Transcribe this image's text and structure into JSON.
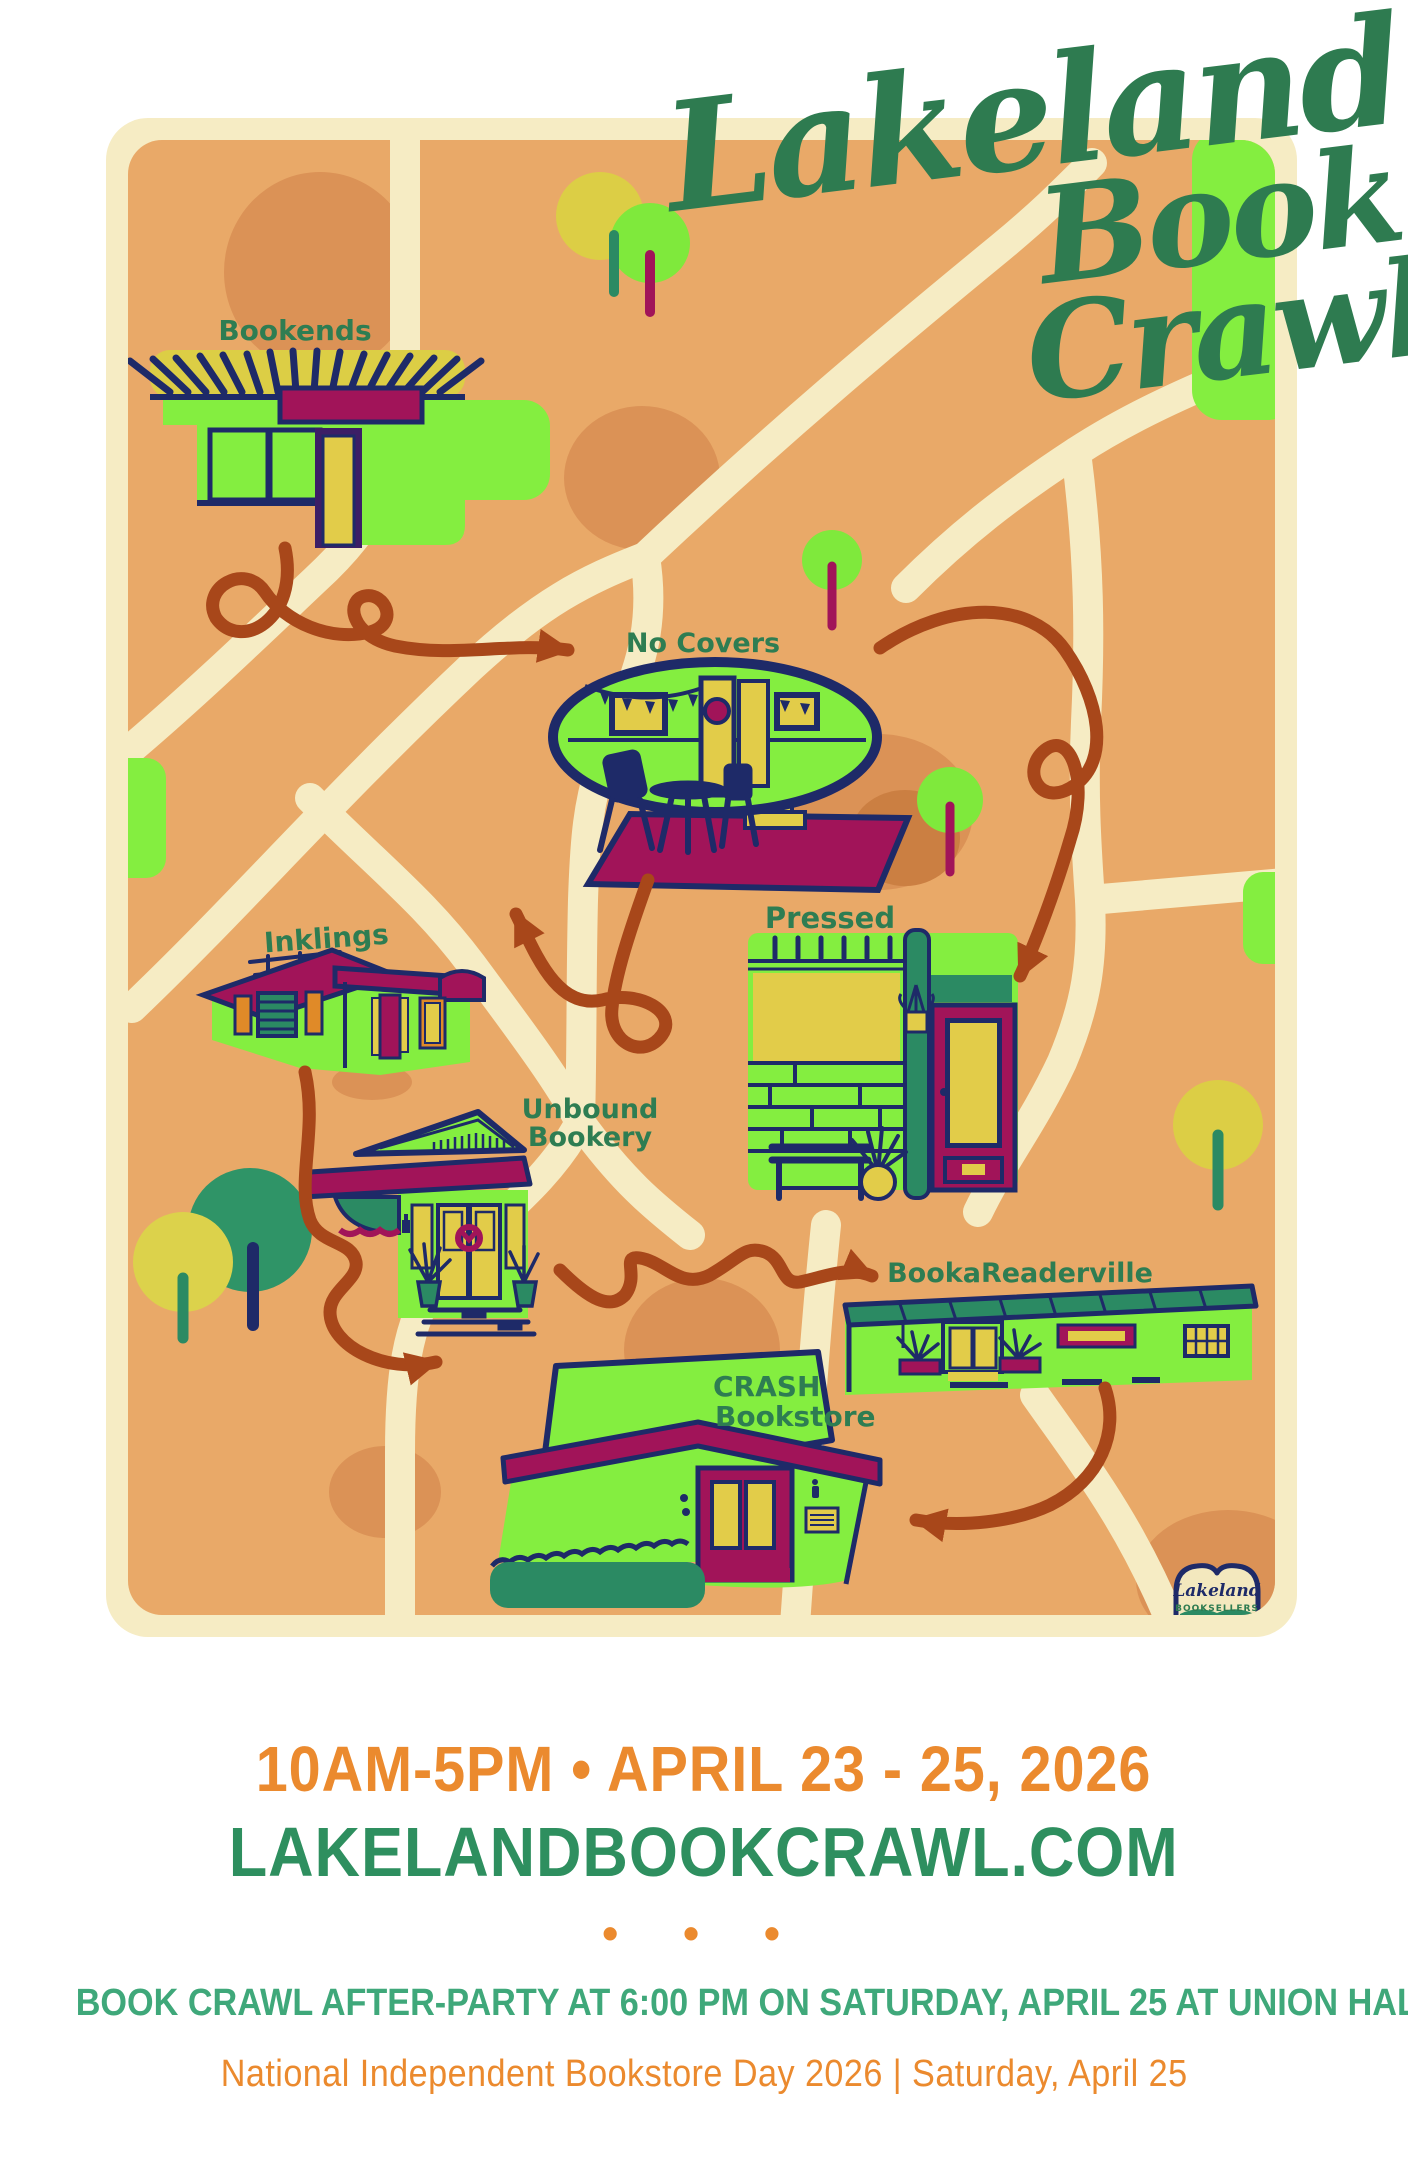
{
  "title": {
    "line1": "Lakeland",
    "line2": "Book",
    "line3": "Crawl"
  },
  "map": {
    "stores": [
      {
        "label": "Bookends"
      },
      {
        "label": "No Covers"
      },
      {
        "label": "Inklings"
      },
      {
        "label": "Pressed"
      },
      {
        "label": "Unbound",
        "label2": "Bookery"
      },
      {
        "label": "BookaReaderville"
      },
      {
        "label": "CRASH",
        "label2": "Bookstore"
      }
    ]
  },
  "logo": {
    "name": "Lakeland",
    "subtitle": "BOOKSELLERS"
  },
  "footer": {
    "hours_dates": "10AM-5PM • APRIL 23 - 25, 2026",
    "website": "LAKELANDBOOKCRAWL.COM",
    "dots": "• • •",
    "afterparty": "BOOK CRAWL AFTER-PARTY AT 6:00 PM ON SATURDAY, APRIL 25 AT UNION HALL",
    "national_day": "National Independent Bookstore Day 2026  | Saturday, April 25"
  },
  "colors": {
    "map_orange": "#E9A968",
    "road_cream": "#F6ECC4",
    "blob_orange": "#DB9256",
    "bright_green": "#84EE40",
    "navy": "#1E2A68",
    "maroon": "#A11459",
    "yellow": "#E2CC49",
    "teal": "#2B8A63",
    "title_green": "#2E7B50",
    "footer_orange": "#EB8A2E",
    "footer_green": "#2E8F5F",
    "arrow_brown": "#A8471A"
  }
}
